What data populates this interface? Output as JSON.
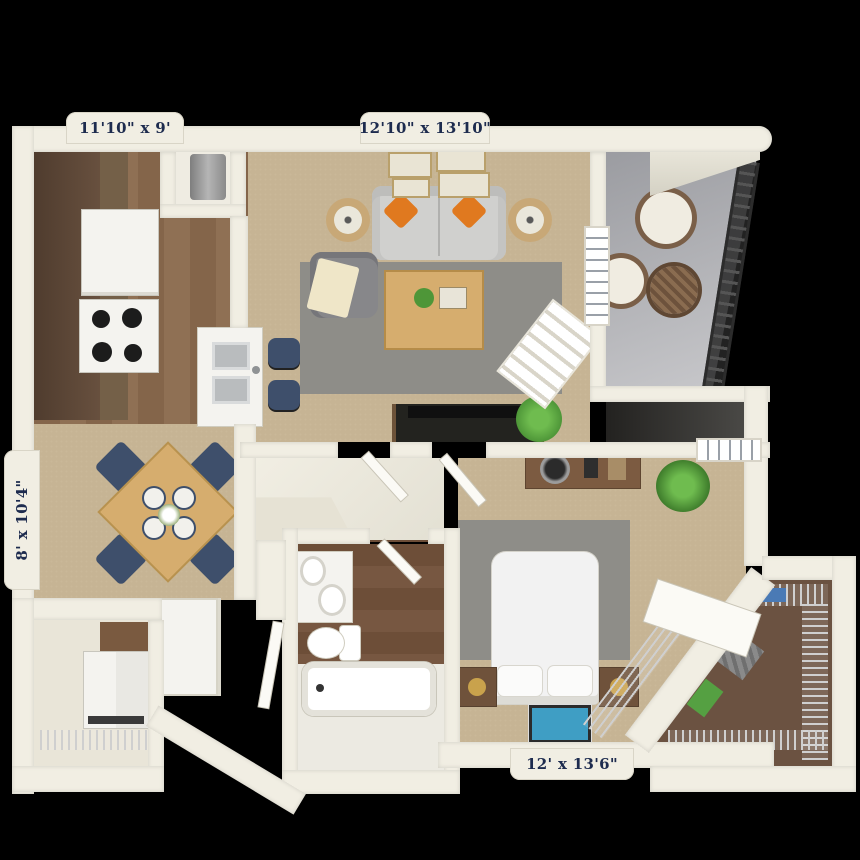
{
  "plan": {
    "type": "apartment-floor-plan-top-view",
    "labels": {
      "kitchen": "11'10\" x 9'",
      "living_room": "12'10\" x 13'10\"",
      "dining": "8' x 10'4\"",
      "bedroom": "12' x 13'6\""
    },
    "palette": {
      "bg": "#000000",
      "wall": "#f1eee3",
      "tabCream": "#f1eee3",
      "labelNavy": "#1d2b4e",
      "carpet": "#c6b494",
      "wood": "#84654a",
      "bathWood": "#6d4e38",
      "cabinetBrown": "#5d4737",
      "applianceWhite": "#f4f3ef",
      "balconyFloor": "#a2a3a8",
      "darkFloor": "#2e2d2b",
      "rug": "#8e8d88",
      "sofa": "#d0d0ce",
      "pillowOrange": "#e0791f",
      "navy": "#3e4f6b",
      "tableWood": "#d6ad6e",
      "tvBlack": "#23231f",
      "plantGreen": "#4e9638",
      "steel": "#b9bcbe",
      "gold": "#c9a24c",
      "artBlue": "#3f9ec4",
      "clothesBlue": "#4a7ab5",
      "clothesGreen": "#55a042",
      "clothesGray": "#8a8a8a",
      "wire": "#cfcfcf"
    }
  }
}
